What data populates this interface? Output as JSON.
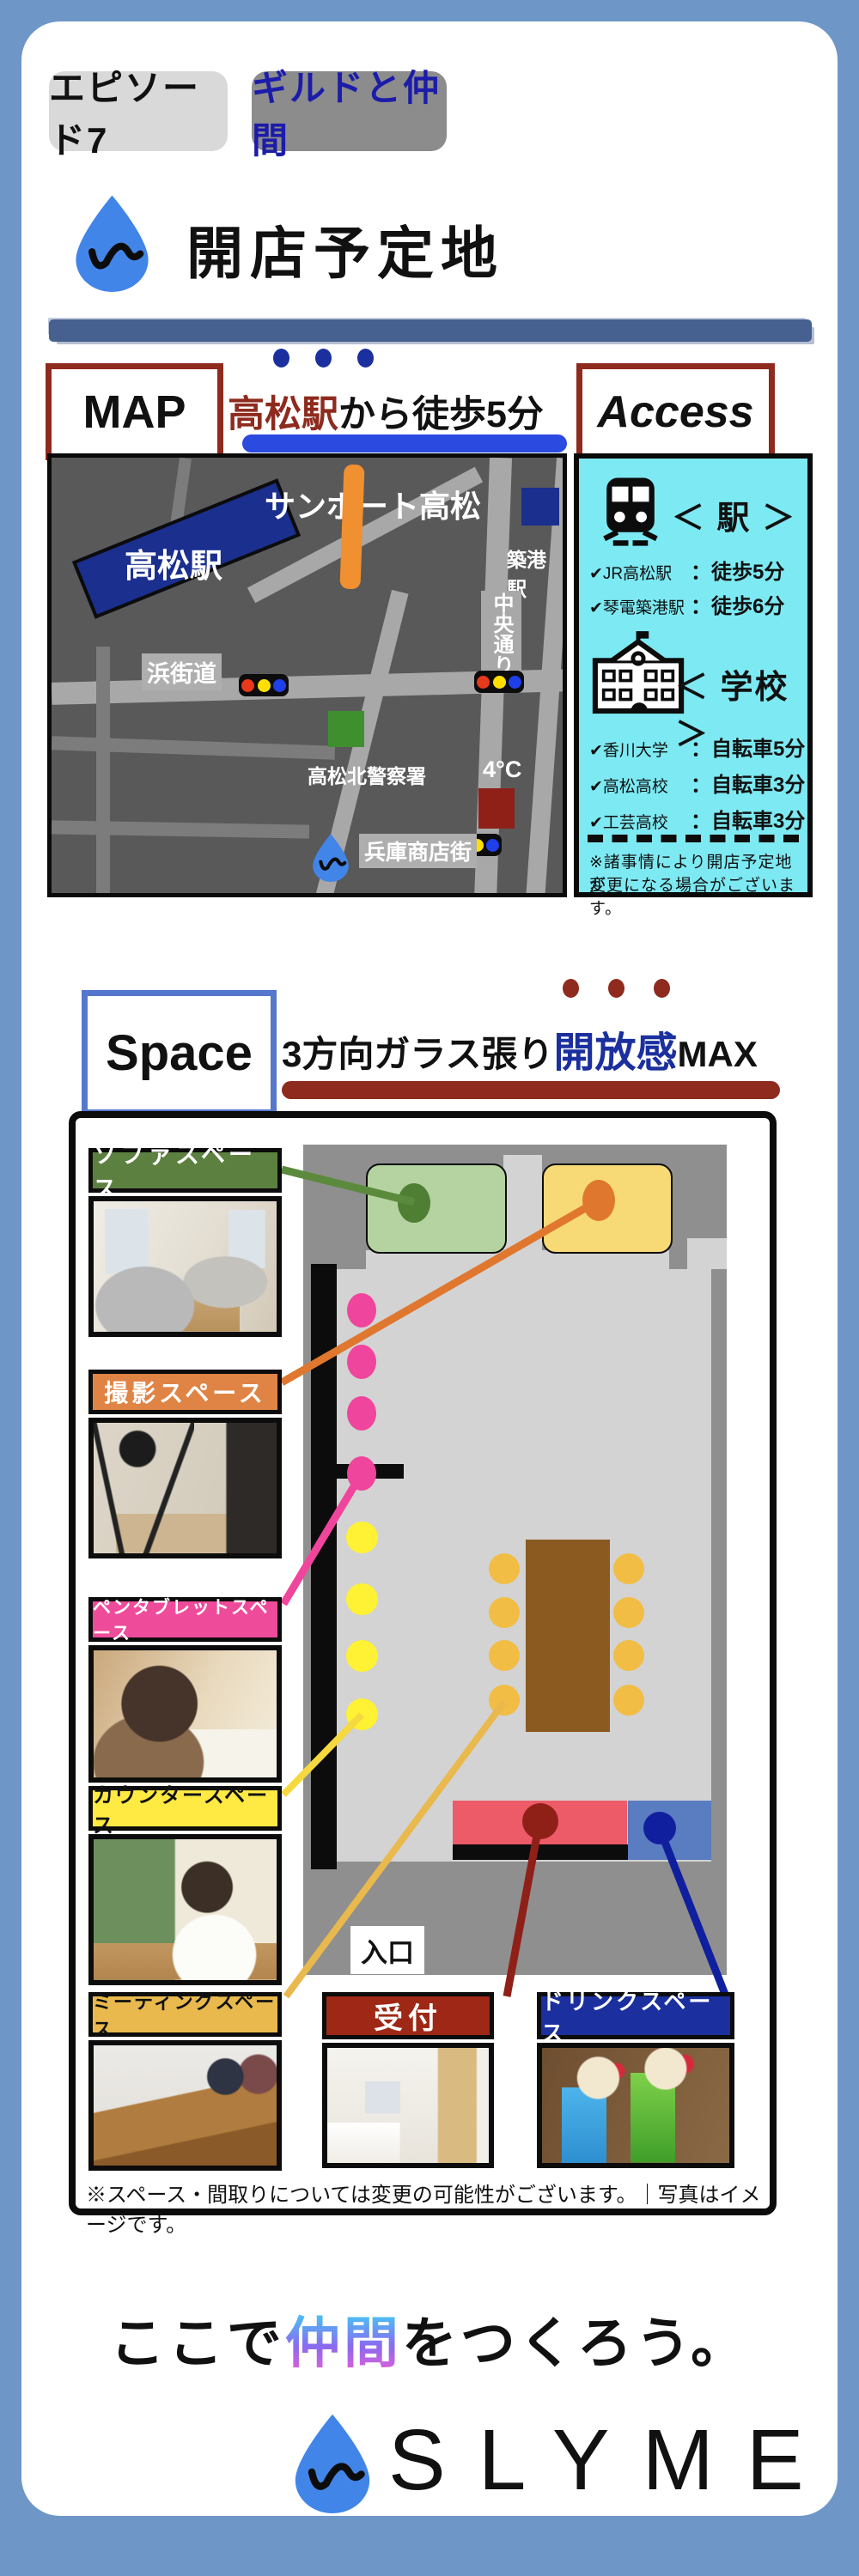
{
  "colors": {
    "page_bg": "#6e97c8",
    "episode_badge_bg": "#d9d9d9",
    "topic_badge_bg": "#8c8c8c",
    "topic_text": "#1c1caa",
    "brand_blue": "#4285e8",
    "crayon_red": "#8e2b1e",
    "crayon_blue": "#5577cc",
    "accent_navy": "#1b2f9e",
    "underline_blue": "#2b4ae0",
    "underline_darkred": "#8e2b1e",
    "map_bg": "#595959",
    "access_bg": "#7de9f2",
    "sofa_green": "#5c8040",
    "shoot_orange": "#e08445",
    "pentab_pink": "#ee4b9b",
    "counter_yellow": "#ffe943",
    "meeting_amber": "#e9b94d",
    "reception_red": "#9e2815",
    "drink_navy": "#1b2f9e",
    "floor_gray": "#d3d3d3",
    "wall_gray": "#8f8f8f",
    "table_brown": "#8a5a20",
    "seat_pink": "#f0459c",
    "seat_yellow": "#fff133",
    "seat_amber": "#f2bd45",
    "reception_counter": "#ed5a68",
    "drink_counter": "#5a7cc0"
  },
  "header": {
    "episode": "エピソード7",
    "topic": "ギルドと仲間"
  },
  "title": "開店予定地",
  "map_section": {
    "map_label": "MAP",
    "access_label": "Access",
    "walk_highlight": "高松駅",
    "walk_rest": "から徒歩5分",
    "map_items": {
      "sunport": "サンポート高松",
      "takamatsu_station": "高松駅",
      "chikko_station": "築港駅",
      "chuo_dori": "中央通り",
      "hama_kaido": "浜街道",
      "police": "高松北警察署",
      "four_c": "4°C",
      "hyogo_shotengai": "兵庫商店街",
      "coworking": "コワーキングスペース",
      "slyme_quoted": "『SLYME』"
    },
    "access_panel": {
      "station_heading": "＜ 駅 ＞",
      "station_items": [
        {
          "name": "✔JR高松駅",
          "value": "：徒歩5分"
        },
        {
          "name": "✔琴電築港駅",
          "value": "：徒歩6分"
        }
      ],
      "school_heading": "＜ 学校 ＞",
      "school_items": [
        {
          "name": "✔香川大学",
          "value": "：自転車5分"
        },
        {
          "name": "✔高松高校",
          "value": "：自転車3分"
        },
        {
          "name": "✔工芸高校",
          "value": "：自転車3分"
        }
      ],
      "note_line1": "※諸事情により開店予定地が",
      "note_line2": "変更になる場合がございます。"
    }
  },
  "space_section": {
    "space_label": "Space",
    "headline_pre": "3方向ガラス張り",
    "headline_highlight": "開放感",
    "headline_post": "MAX",
    "entrance_label": "入口",
    "area_labels": {
      "sofa": "ソファスペース",
      "shooting": "撮影スペース",
      "pentablet": "ペンタブレットスペース",
      "counter": "カウンタースペース",
      "meeting": "ミーティングスペース",
      "reception": "受付",
      "drink": "ドリンクスペース"
    },
    "note": "※スペース・間取りについては変更の可能性がございます。｜写真はイメージです。"
  },
  "footer": {
    "tagline_pre": "ここで",
    "tagline_highlight": "仲間",
    "tagline_post": "をつくろう。",
    "brand": "SLYME"
  }
}
